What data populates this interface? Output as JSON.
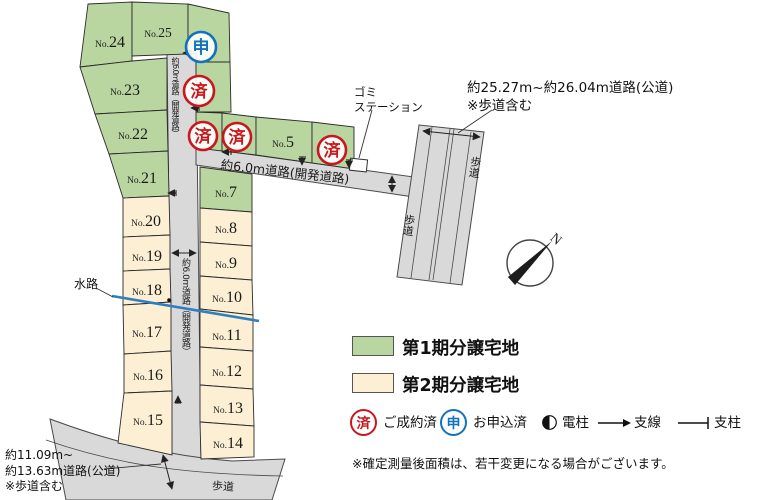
{
  "labels": {
    "no_prefix": "No."
  },
  "map": {
    "lots": [
      {
        "id": "lot-24",
        "number": "24"
      },
      {
        "id": "lot-25",
        "number": "25"
      },
      {
        "id": "lot-23",
        "number": "23"
      },
      {
        "id": "lot-22",
        "number": "22"
      },
      {
        "id": "lot-21",
        "number": "21"
      },
      {
        "id": "lot-5",
        "number": "5"
      },
      {
        "id": "lot-7",
        "number": "7"
      },
      {
        "id": "lot-8",
        "number": "8"
      },
      {
        "id": "lot-9",
        "number": "9"
      },
      {
        "id": "lot-10",
        "number": "10"
      },
      {
        "id": "lot-11",
        "number": "11"
      },
      {
        "id": "lot-12",
        "number": "12"
      },
      {
        "id": "lot-13",
        "number": "13"
      },
      {
        "id": "lot-14",
        "number": "14"
      },
      {
        "id": "lot-15",
        "number": "15"
      },
      {
        "id": "lot-16",
        "number": "16"
      },
      {
        "id": "lot-17",
        "number": "17"
      },
      {
        "id": "lot-18",
        "number": "18"
      },
      {
        "id": "lot-19",
        "number": "19"
      },
      {
        "id": "lot-20",
        "number": "20"
      }
    ],
    "road_labels": {
      "dev_road_vertical": "約6.0m道路（開発道路）",
      "dev_road_horizontal": "約6.0m道路(開発道路)",
      "main_road_line1": "約25.27m~約26.04m道路(公道)",
      "main_road_line2": "※歩道含む",
      "south_road_line1": "約11.09m~",
      "south_road_line2": "約13.63m道路(公道)",
      "south_road_line3": "※歩道含む",
      "sidewalk": "歩道",
      "waterway": "水路",
      "garbage_line1": "ゴミ",
      "garbage_line2": "ステーション"
    },
    "compass_n": "N"
  },
  "legend": {
    "phase1": "第1期分譲宅地",
    "phase2": "第2期分譲宅地",
    "sold_char": "済",
    "sold_label": "ご成約済",
    "applied_char": "申",
    "applied_label": "お申込済",
    "pole_label": "電柱",
    "wire_label": "支線",
    "post_label": "支柱",
    "colors": {
      "phase1": "#b9d5a0",
      "phase2": "#fcefd4",
      "sold": "#c9171e",
      "applied": "#1272bb",
      "waterway": "#2d7fc1",
      "road": "#d9d9da"
    }
  },
  "note": "※確定測量後面積は、若干変更になる場合がございます。"
}
